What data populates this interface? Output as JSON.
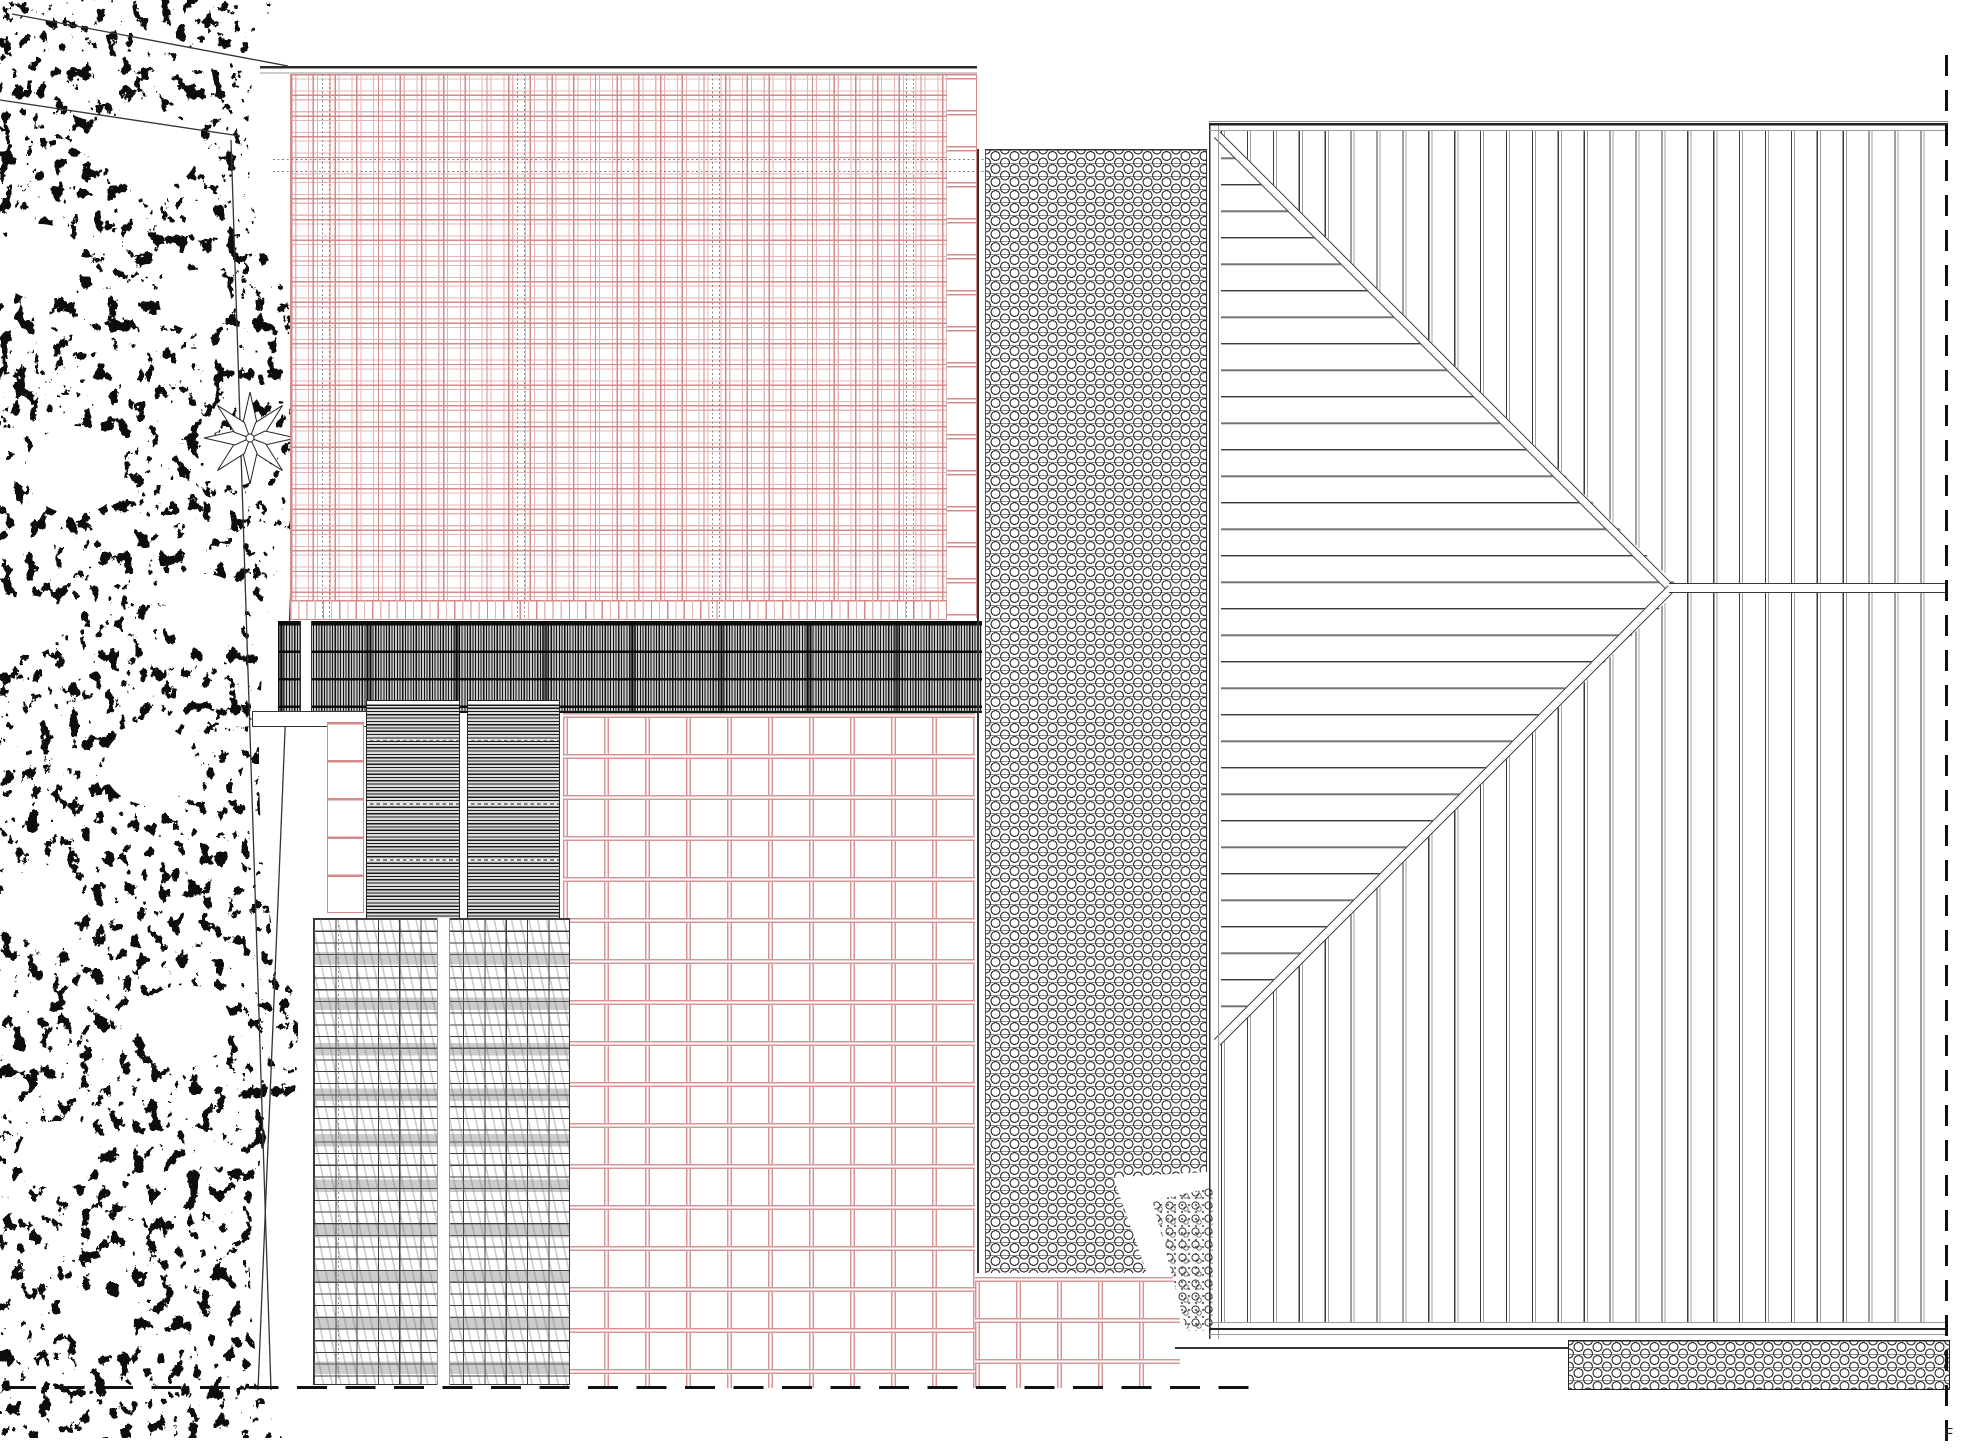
{
  "annotation": {
    "corner_label": "F"
  },
  "colors": {
    "tile_pink": "#d28a8a",
    "tile_pink_light": "#e5b6b6",
    "paving_pink": "#d49697",
    "ink_dark": "#222222",
    "line_grey": "#9a9a9a"
  }
}
